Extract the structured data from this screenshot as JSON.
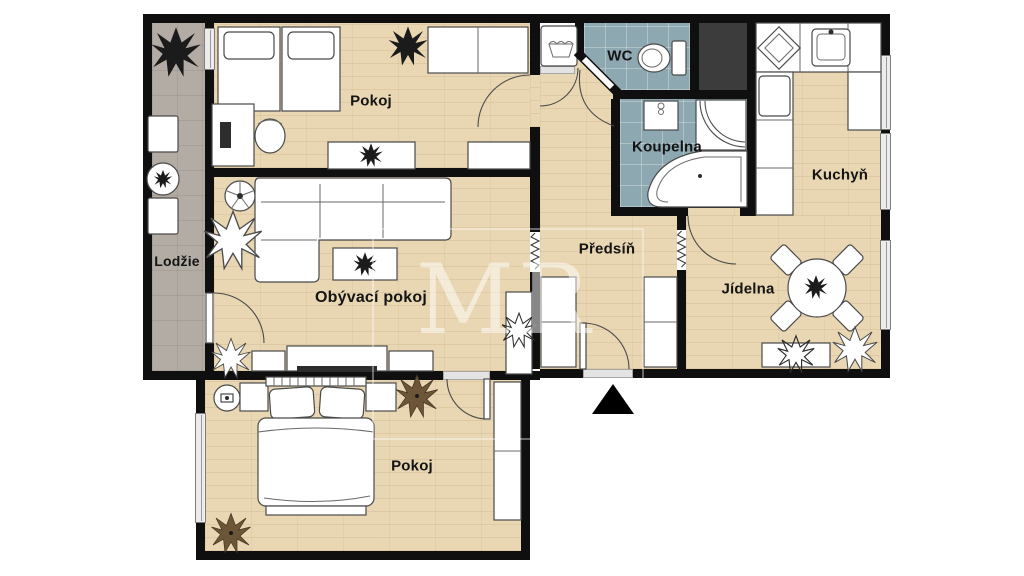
{
  "plan": {
    "watermark": "MR",
    "rooms": {
      "pokoj_top": {
        "label": "Pokoj"
      },
      "lodzie": {
        "label": "Lodžie"
      },
      "obyvaci_pokoj": {
        "label": "Obývací pokoj"
      },
      "pokoj_bottom": {
        "label": "Pokoj"
      },
      "wc": {
        "label": "WC"
      },
      "koupelna": {
        "label": "Koupelna"
      },
      "predsin": {
        "label": "Předsíň"
      },
      "kuchyn": {
        "label": "Kuchyň"
      },
      "jidelna": {
        "label": "Jídelna"
      }
    },
    "colors": {
      "wall": "#0f0f0f",
      "wood_floor": "#e9d6b2",
      "tile_floor": "#8da8b1",
      "loggia_floor": "#b3aca4",
      "shaft": "#3c3c3c",
      "furniture": "#ffffff",
      "background": "#ffffff",
      "entrance_marker": "#000000"
    }
  }
}
